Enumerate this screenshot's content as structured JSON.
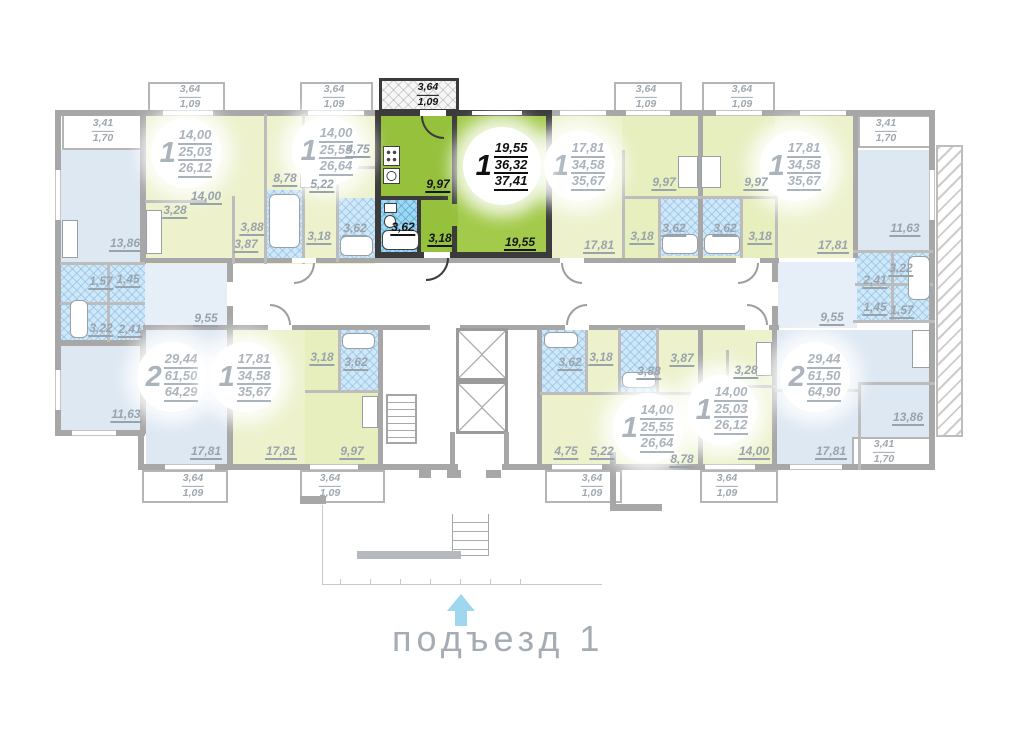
{
  "caption": {
    "text": "подъезд 1"
  },
  "colors": {
    "highlight_green": "#95c13d",
    "highlight_green_light": "#a3ca4a",
    "pale_green": "#edf2cd",
    "pale_blue": "#dde8f3",
    "bath_blue": "#cfe7f7",
    "bath_blue_bright": "#9ed9f4",
    "wall_gray": "#a7a7a7",
    "wall_dark": "#3b3b3b",
    "label_gray": "#99a3ab",
    "label_dark": "#141414",
    "arrow_blue": "#9fd7ee"
  },
  "badges": [
    {
      "num": "1",
      "a1": "14,00",
      "a2": "25,03",
      "a3": "26,12"
    },
    {
      "num": "1",
      "a1": "14,00",
      "a2": "25,55",
      "a3": "26,64"
    },
    {
      "num": "1",
      "a1": "19,55",
      "a2": "36,32",
      "a3": "37,41"
    },
    {
      "num": "1",
      "a1": "17,81",
      "a2": "34,58",
      "a3": "35,67"
    },
    {
      "num": "1",
      "a1": "17,81",
      "a2": "34,58",
      "a3": "35,67"
    },
    {
      "num": "2",
      "a1": "29,44",
      "a2": "61,50",
      "a3": "64,29"
    },
    {
      "num": "1",
      "a1": "17,81",
      "a2": "34,58",
      "a3": "35,67"
    },
    {
      "num": "1",
      "a1": "14,00",
      "a2": "25,55",
      "a3": "26,64"
    },
    {
      "num": "1",
      "a1": "14,00",
      "a2": "25,03",
      "a3": "26,12"
    },
    {
      "num": "2",
      "a1": "29,44",
      "a2": "61,50",
      "a3": "64,90"
    }
  ],
  "labels": [
    "13,86",
    "14,00",
    "3,28",
    "8,78",
    "4,75",
    "5,22",
    "3,88",
    "3,87",
    "3,18",
    "3,62",
    "9,97",
    "3,62",
    "3,18",
    "19,55",
    "17,81",
    "3,18",
    "3,62",
    "9,97",
    "9,97",
    "3,62",
    "3,18",
    "17,81",
    "11,63",
    "3,22",
    "2,41",
    "1,45",
    "1,57",
    "1,57",
    "1,45",
    "3,22",
    "2,41",
    "9,55",
    "11,63",
    "17,81",
    "17,81",
    "9,97",
    "3,18",
    "3,62",
    "3,62",
    "3,18",
    "3,88",
    "3,87",
    "4,75",
    "5,22",
    "8,78",
    "3,28",
    "14,00",
    "17,81",
    "13,86",
    "9,55"
  ],
  "balconies": [
    {
      "a": "3,41",
      "b": "1,70"
    },
    {
      "a": "3,64",
      "b": "1,09"
    },
    {
      "a": "3,64",
      "b": "1,09"
    },
    {
      "a": "3,64",
      "b": "1,09"
    },
    {
      "a": "3,64",
      "b": "1,09"
    },
    {
      "a": "3,64",
      "b": "1,09"
    },
    {
      "a": "3,41",
      "b": "1,70"
    },
    {
      "a": "3,64",
      "b": "1,09"
    },
    {
      "a": "3,64",
      "b": "1,09"
    },
    {
      "a": "3,64",
      "b": "1,09"
    },
    {
      "a": "3,64",
      "b": "1,09"
    },
    {
      "a": "3,41",
      "b": "1,70"
    }
  ]
}
